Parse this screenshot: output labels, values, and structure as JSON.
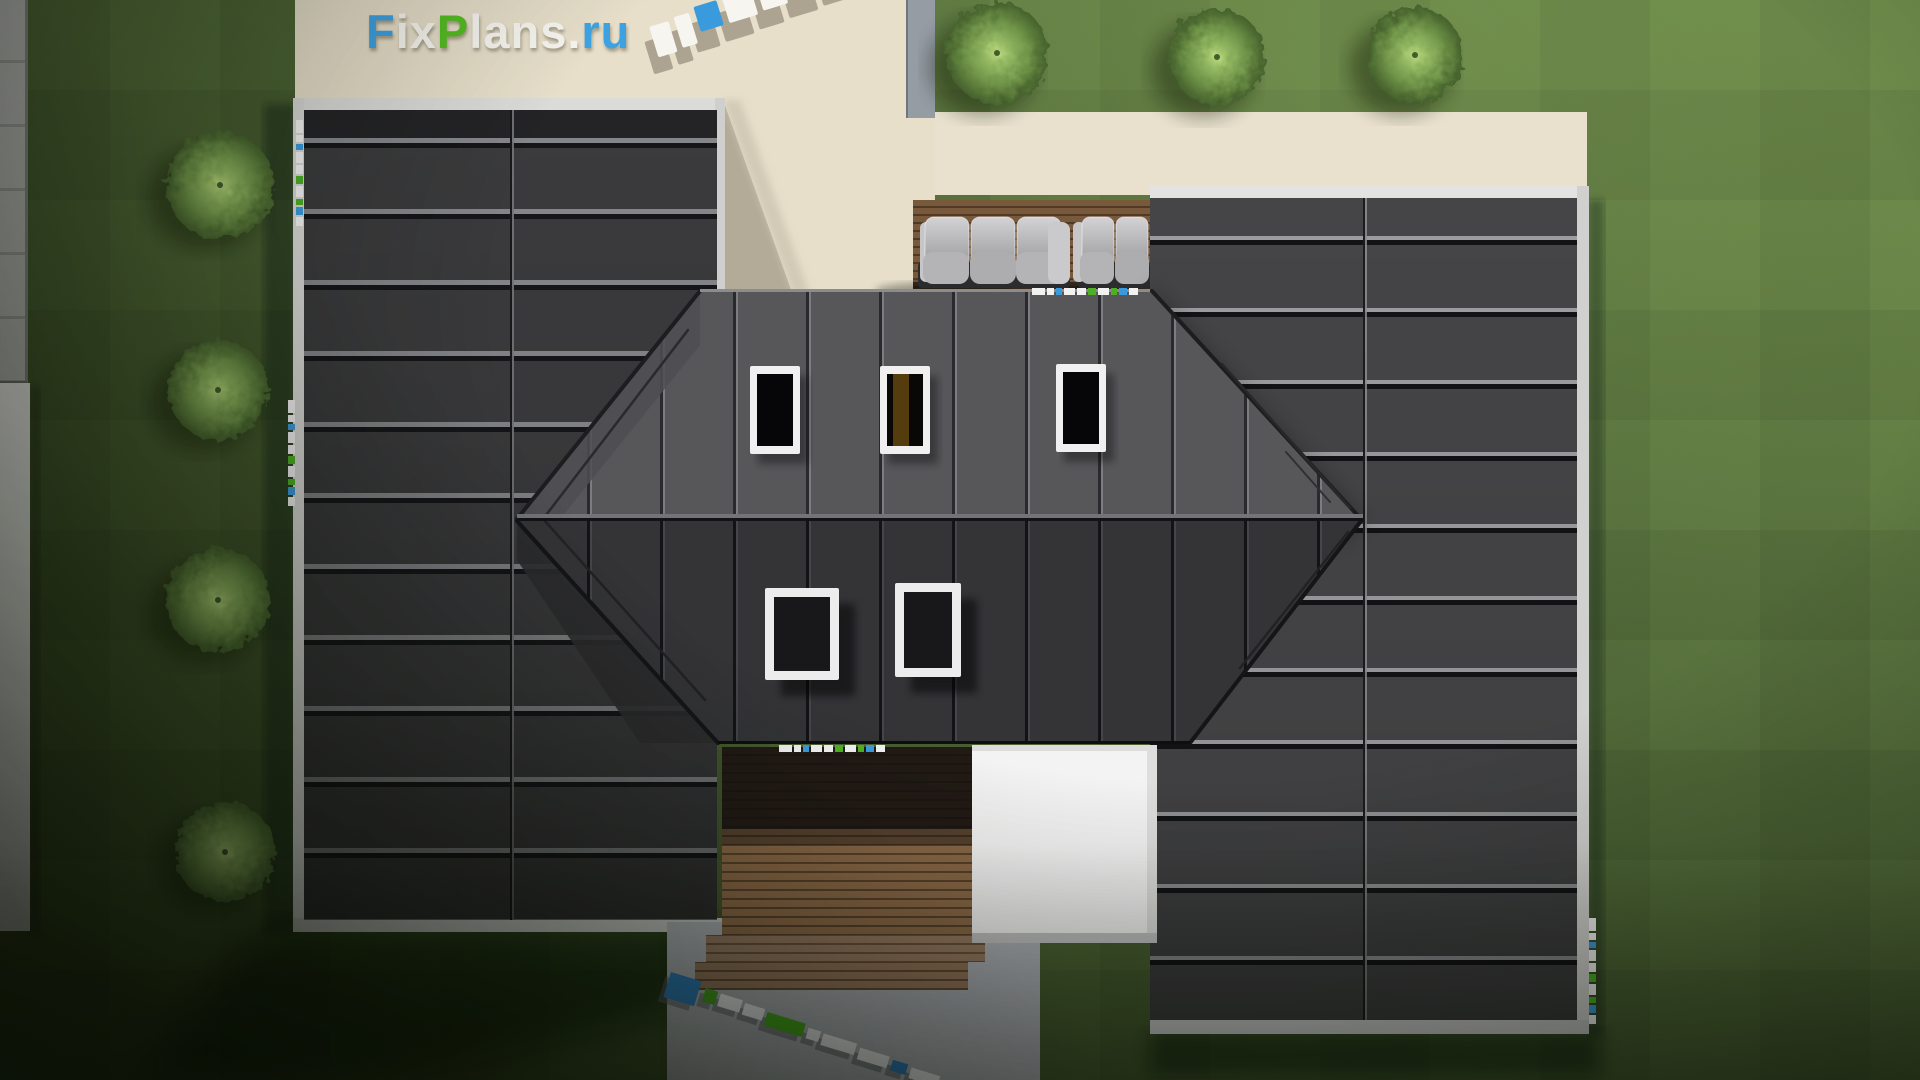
{
  "site": {
    "logo_text": "FixPlans.ru",
    "logo_parts": [
      {
        "text": "F",
        "color": "#3ea2e2"
      },
      {
        "text": "ix",
        "color": "#f7f5ef"
      },
      {
        "text": "P",
        "color": "#55bd22"
      },
      {
        "text": "lans",
        "color": "#f7f5ef"
      },
      {
        "text": ".",
        "color": "#f7f5ef"
      },
      {
        "text": "ru",
        "color": "#3ea2e2"
      }
    ]
  },
  "scene": {
    "view": "aerial top-down render of a house",
    "counts": {
      "skylights_upper_row": 3,
      "skylights_lower_row": 2,
      "bushes_left_column": 4,
      "bushes_top_right_row": 3,
      "sofas": 2
    }
  },
  "palette": {
    "grass": "#5b7540",
    "patio_beige": "#e7dfca",
    "patio_shadow": "#b3aa98",
    "roof_dark_panel": "#3b3b3d",
    "roof_right_panel": "#454547",
    "roof_upper_slope": "#57575a",
    "roof_lower_slope": "#343437",
    "deck_wood": "#8a6847",
    "white_flat_roof": "#f3f3f3",
    "concrete": "#b6b9bf",
    "sofa_cushion": "#bcbcbe",
    "watermark_blue": "#3a9bdc",
    "watermark_green": "#4db024",
    "watermark_white": "#f2f2f2"
  }
}
